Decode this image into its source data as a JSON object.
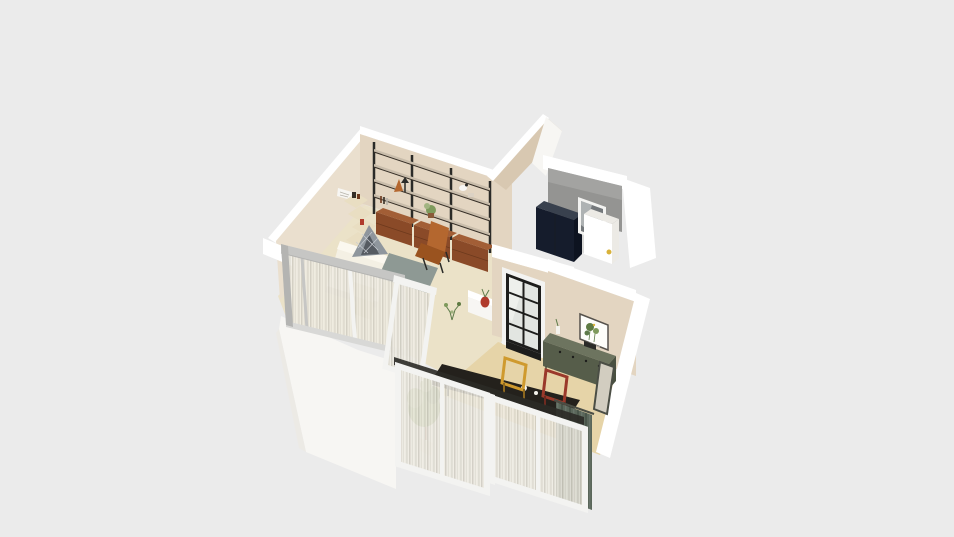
{
  "scene": {
    "type": "3d-floorplan-render",
    "view": "isometric-cutaway",
    "rooms": [
      "living-room",
      "utility-room",
      "kitchen-dining",
      "glazed-balcony"
    ],
    "objects": [
      "wall-shelving-unit",
      "wood-drawer-cabinets",
      "leather-lounge-chair",
      "corner-wall-shelves",
      "wall-paper-art",
      "bed",
      "teepee-cushion",
      "bedside-steps",
      "gray-rug",
      "console-table",
      "red-vase",
      "small-floor-plant",
      "navy-wardrobe",
      "utility-window",
      "washer-cabinet",
      "steel-grid-window",
      "botanical-artwork",
      "green-sideboard",
      "leaning-mirror",
      "dining-table",
      "yellow-frame-chair",
      "red-frame-chair",
      "tall-potted-plant",
      "green-drape",
      "glass-partition",
      "open-glass-door",
      "sliding-glass-doors",
      "sheer-curtains"
    ]
  },
  "palette": {
    "bg": "#ebebeb",
    "white": "#ffffff",
    "white_soft": "#f7f6f3",
    "white_dim": "#eceae5",
    "frame_gray": "#c6c6c4",
    "frame_white": "#f3f3f1",
    "rail_gray": "#d8d8d6",
    "end_gray": "#b4b4b2",
    "wall_tan": "#e3d5c1",
    "wall_tan_light": "#eadfce",
    "wall_tan_dark": "#d8c8b1",
    "floor_cream": "#ebe2c8",
    "floor_tan": "#e6d4a8",
    "floor_gray": "#d9d9d7",
    "concrete": "#949492",
    "concrete_light": "#b2b2b0",
    "navy": "#151c2c",
    "navy_top": "#39414e",
    "navy_side": "#0d1320",
    "glass_dark": "#74787b",
    "glass_light": "#c2c5c6",
    "glass_pane": "#e2e5e1",
    "black": "#1d1d1b",
    "steel": "#2b2b28",
    "shelf_board": "#c9bdab",
    "shelf_board_light": "#dcd2c4",
    "shelf_edge": "#352e26",
    "wood": "#8a4a28",
    "wood_light": "#a25e36",
    "wood_dark": "#6e391d",
    "leather": "#b4672f",
    "leather_dark": "#9a531f",
    "bed_white": "#f4f0e4",
    "bed_fold": "#fbf8ef",
    "bed_shade": "#ddd5c0",
    "bed_cream": "#e9dec2",
    "bed_cream_dark": "#e0d2ae",
    "pillow_gray": "#8f969d",
    "pillow_dark": "#565b62",
    "pillow_lattice": "#c9cdd3",
    "rug_gray": "#8e9994",
    "counter_top": "#6d745f",
    "counter_front": "#565d4a",
    "counter_side": "#495040",
    "chair_yellow": "#cf9a2e",
    "chair_yellow_dark": "#8d671e",
    "chair_red": "#9a392b",
    "chair_red_dark": "#6e2a20",
    "table_black": "#24211c",
    "table_edge": "#141210",
    "curtain_base": "#f0ede4",
    "curtain_s1": "#dedbd1",
    "curtain_s2": "#c9c6bb",
    "green_curtain": "#5a665a",
    "green_curtain_dark": "#49554a",
    "green_curtain_light": "#68746a",
    "plant_green": "#7e9a5c",
    "plant_green_dark": "#5e7a43",
    "plant_green_light": "#a2b481",
    "red_vase": "#b03b2c",
    "pot_brown": "#8a5a39",
    "pot_white": "#e9e5da",
    "cup_white": "#f4f2ec",
    "dot_yellow": "#d9b23a",
    "mirror_face": "#d2cdc0",
    "mirror_frame": "#4b4e45",
    "art_frame": "#56524c",
    "art_bg": "#fdfdfa",
    "caption": "#b7b3aa",
    "stem": "#5d7a49",
    "door_track": "#2b2a26"
  }
}
